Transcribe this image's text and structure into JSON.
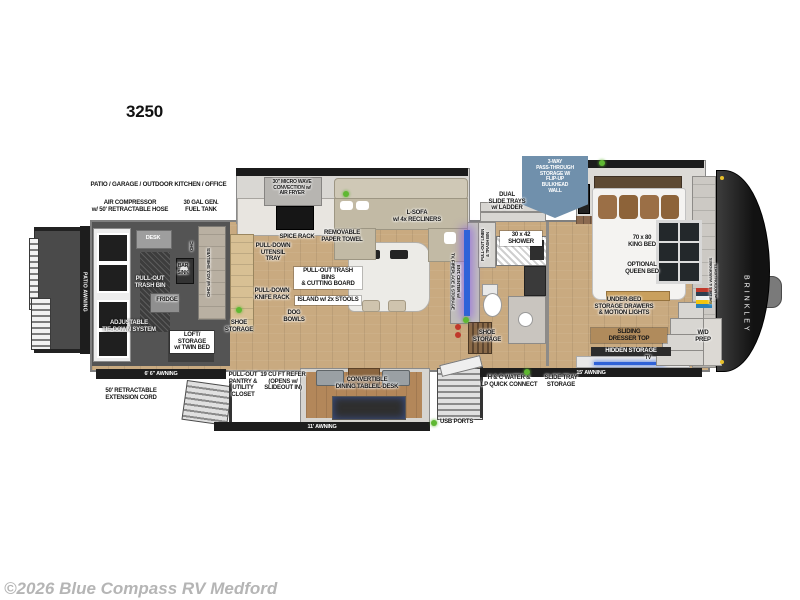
{
  "title": "3250",
  "watermark": "©2026 Blue Compass RV Medford",
  "colors": {
    "accent_green": "#5fb832",
    "callout_blue": "#7090ac",
    "tv_blue": "#2f62d8",
    "wood_floor": "#c9aa80",
    "garage_floor": "#555555",
    "front_cap": "#1c1c1c",
    "label_text": "#161616"
  },
  "exterior": {
    "zone": "PATIO / GARAGE / OUTDOOR KITCHEN / OFFICE",
    "air_compressor": "AIR COMPRESSOR\nw/ 50' RETRACTABLE HOSE",
    "fuel_tank": "30 GAL GEN.\nFUEL TANK",
    "patio_awning": "PATIO AWNING",
    "awning_6_6": "6' 6\" AWNING",
    "ext_cord": "50' RETRACTABLE\nEXTENSION CORD",
    "awning_11": "11' AWNING",
    "awning_15": "15' AWNING",
    "usb_ports": "USB PORTS",
    "brand": "BRINKLEY"
  },
  "garage": {
    "desk": "DESK",
    "ohc": "OHC",
    "bar_sink": "BAR\nSINK",
    "trash_bin": "PULL-OUT\nTRASH BIN",
    "fridge": "FRIDGE",
    "ohc_shelves": "OHC w/ ADJ. SHELVES",
    "tie_down": "ADJUSTABLE\nTIE-DOWN SYSTEM",
    "loft": "LOFT/\nSTORAGE\nw/ TWIN BED"
  },
  "kitchen": {
    "microwave": "30\" MICRO WAVE\nCONVECTION w/\nAIR FRYER",
    "spice_rack": "SPICE RACK",
    "paper_towel": "REMOVABLE\nPAPER TOWEL",
    "utensil_tray": "PULL-DOWN\nUTENSIL\nTRAY",
    "trash_bins": "PULL-OUT TRASH BINS\n& CUTTING BOARD",
    "island": "ISLAND w/ 2x STOOLS",
    "knife_rack": "PULL-DOWN\nKNIFE RACK",
    "dog_bowls": "DOG\nBOWLS",
    "shoe_storage": "SHOE\nSTORAGE"
  },
  "living": {
    "sofa": "L-SOFA\nw/ 4x RECLINERS",
    "dual_slide_trays": "DUAL\nSLIDE TRAYS\nw/ LADDER",
    "ent_center": "ENT. CENTER w/\nTV, FIREPLACE & STORAGE",
    "shoe_storage": "SHOE\nSTORAGE"
  },
  "bath": {
    "linen": "PULL-OUT LINEN\n& TRASH BIN",
    "shower": "30 x 42\nSHOWER"
  },
  "bedroom": {
    "callout": "3-WAY\nPASS-THROUGH\nSTORAGE W/\nFLIP-UP\nBULKHEAD\nWALL",
    "king_bed": "70 x 80\nKING BED",
    "queen_bed": "OPTIONAL\nQUEEN BED",
    "under_bed": "UNDER-BED\nSTORAGE DRAWERS\n& MOTION LIGHTS",
    "dresser": "SLIDING\nDRESSER TOP",
    "hidden_storage": "HIDDEN STORAGE",
    "tv": "TV",
    "wardrobe": "SHELVES & WARDROBES\nw/ MOTION LIGHTS",
    "wd_prep": "W/D\nPREP"
  },
  "lower": {
    "pantry": "PULL-OUT\nPANTRY &\nUTILITY\nCLOSET",
    "refer": "19 CU FT REFER\n(OPENS w/\nSLIDEOUT IN)",
    "dining": "CONVERTIBLE\nDINING TABLE/L-DESK",
    "hc_water": "H & C WATER &\nLP QUICK CONNECT",
    "slide_tray": "SLIDE TRAY\nSTORAGE"
  }
}
